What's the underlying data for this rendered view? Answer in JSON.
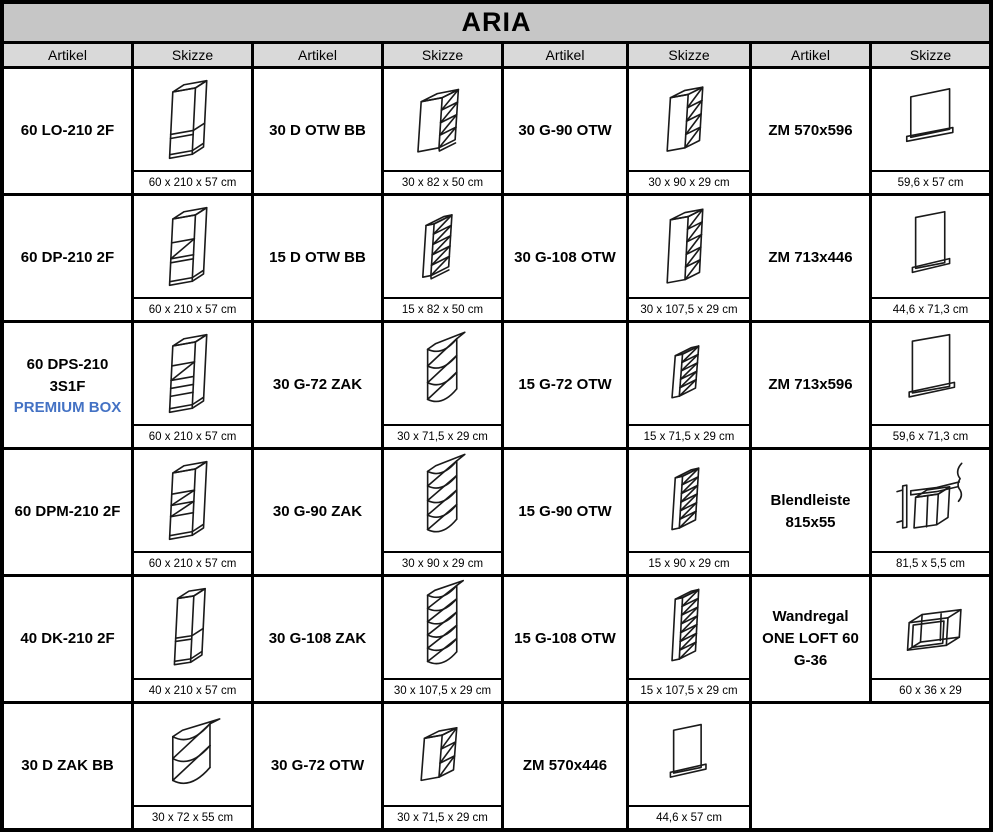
{
  "title": "ARIA",
  "columns": {
    "artikel": "Artikel",
    "skizze": "Skizze"
  },
  "colors": {
    "title_bg": "#c6c6c6",
    "header_bg": "#d9d9d9",
    "premium_note": "#4472c4",
    "border": "#000000"
  },
  "products": [
    {
      "code": "60 LO-210 2F",
      "dims": "60 x 210 x 57 cm",
      "sketch": "tall-cabinet-2-doors"
    },
    {
      "code": "30 D OTW BB",
      "dims": "30 x 82 x 50 cm",
      "sketch": "open-base-shelf-unit"
    },
    {
      "code": "30 G-90 OTW",
      "dims": "30 x 90 x 29 cm",
      "sketch": "open-wall-shelf-unit"
    },
    {
      "code": "ZM 570x596",
      "dims": "59,6 x 57 cm",
      "sketch": "appliance-front-panel"
    },
    {
      "code": "60 DP-210 2F",
      "dims": "60 x 210 x 57 cm",
      "sketch": "tall-oven-housing"
    },
    {
      "code": "15 D OTW BB",
      "dims": "15 x 82 x 50 cm",
      "sketch": "open-base-shelf-unit-narrow"
    },
    {
      "code": "30 G-108 OTW",
      "dims": "30 x 107,5 x 29 cm",
      "sketch": "open-wall-shelf-unit"
    },
    {
      "code": "ZM 713x446",
      "dims": "44,6 x 71,3 cm",
      "sketch": "appliance-front-panel"
    },
    {
      "code": "60 DPS-210 3S1F",
      "note": "PREMIUM BOX",
      "dims": "60 x 210 x 57 cm",
      "sketch": "tall-oven-housing-drawers"
    },
    {
      "code": "30 G-72 ZAK",
      "dims": "30 x 71,5 x 29 cm",
      "sketch": "corner-wall-shelf-unit"
    },
    {
      "code": "15 G-72 OTW",
      "dims": "15 x 71,5 x 29 cm",
      "sketch": "open-wall-shelf-unit-narrow"
    },
    {
      "code": "ZM 713x596",
      "dims": "59,6 x 71,3 cm",
      "sketch": "appliance-front-panel"
    },
    {
      "code": "60 DPM-210 2F",
      "dims": "60 x 210 x 57 cm",
      "sketch": "tall-microwave-housing"
    },
    {
      "code": "30 G-90 ZAK",
      "dims": "30 x 90 x 29 cm",
      "sketch": "corner-wall-shelf-unit"
    },
    {
      "code": "15 G-90 OTW",
      "dims": "15 x 90 x 29 cm",
      "sketch": "open-wall-shelf-unit-narrow"
    },
    {
      "code": "Blendleiste 815x55",
      "dims": "81,5 x 5,5 cm",
      "sketch": "filler-strip-with-cabinet"
    },
    {
      "code": "40 DK-210 2F",
      "dims": "40 x 210 x 57 cm",
      "sketch": "tall-cabinet-2-doors-narrow"
    },
    {
      "code": "30 G-108 ZAK",
      "dims": "30 x 107,5 x 29 cm",
      "sketch": "corner-wall-shelf-unit"
    },
    {
      "code": "15 G-108 OTW",
      "dims": "15 x 107,5 x 29 cm",
      "sketch": "open-wall-shelf-unit-narrow"
    },
    {
      "code": "Wandregal ONE LOFT 60 G-36",
      "dims": "60 x 36 x 29",
      "sketch": "open-frame-wall-shelf"
    },
    {
      "code": "30 D ZAK BB",
      "dims": "30 x 72 x 55 cm",
      "sketch": "corner-base-shelf-unit"
    },
    {
      "code": "30 G-72 OTW",
      "dims": "30 x 71,5 x 29 cm",
      "sketch": "open-wall-shelf-unit"
    },
    {
      "code": "ZM 570x446",
      "dims": "44,6 x 57 cm",
      "sketch": "appliance-front-panel"
    }
  ]
}
